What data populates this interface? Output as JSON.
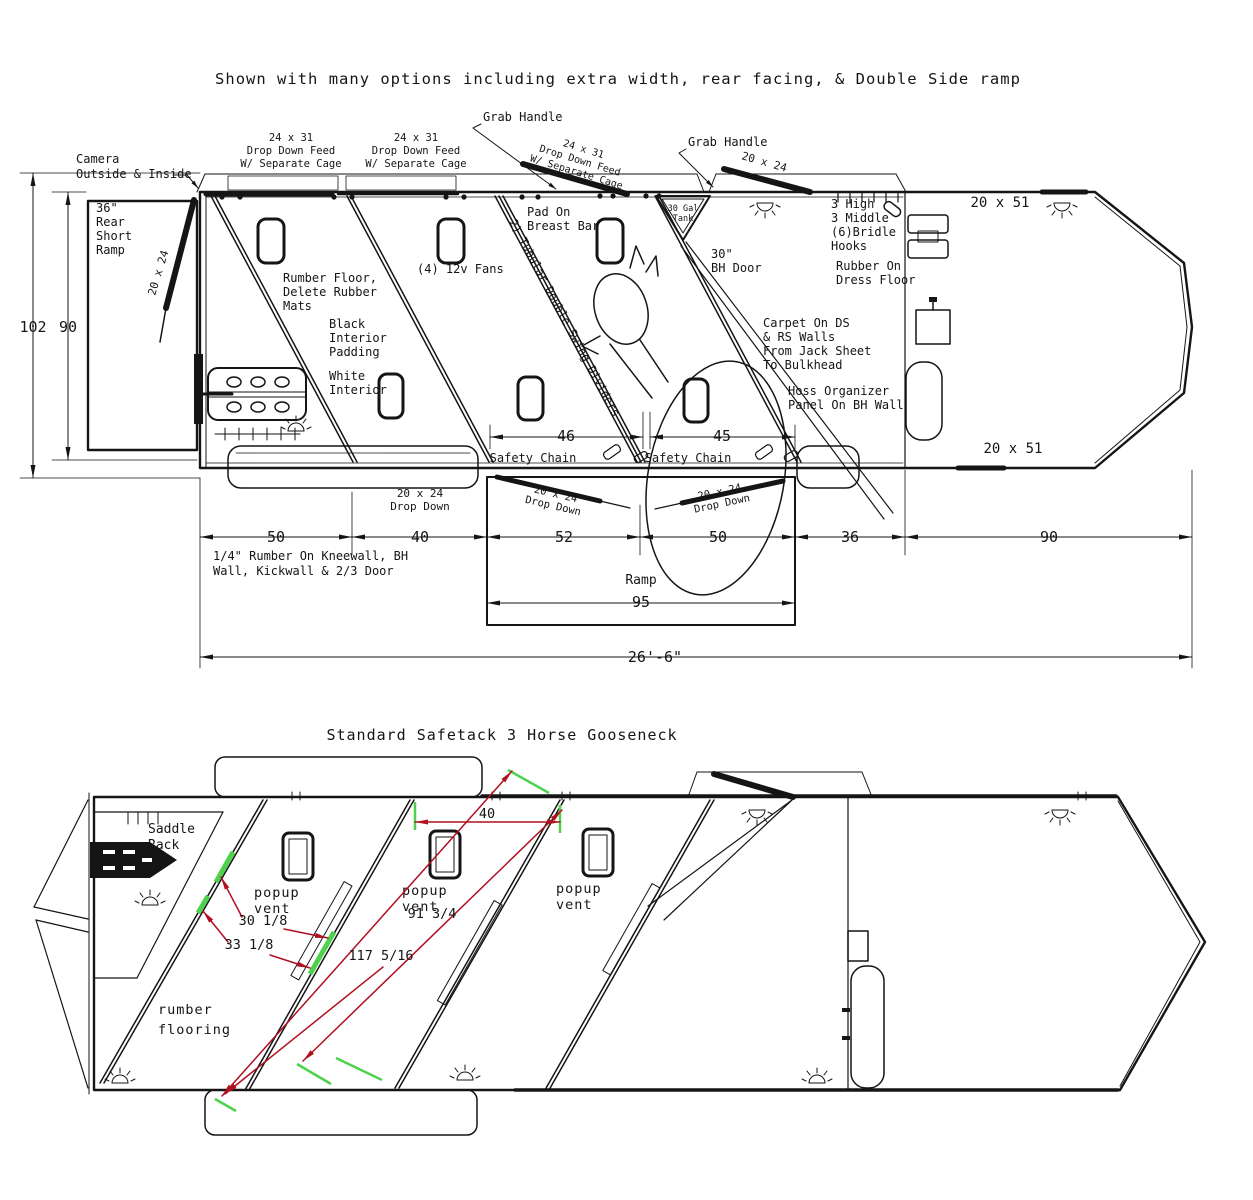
{
  "colors": {
    "ink": "#151515",
    "red": "#b01020",
    "green": "#4ed24e"
  },
  "top": {
    "title": "Shown with many options including extra width, rear facing, & Double Side ramp",
    "camera": [
      "Camera",
      "Outside & Inside"
    ],
    "rear_ramp": [
      "36\"",
      "Rear",
      "Short",
      "Ramp"
    ],
    "size_20x24": "20 x 24",
    "feed_door": [
      "24 x 31",
      "Drop Down Feed",
      "W/ Separate Cage"
    ],
    "grab_handle": "Grab Handle",
    "tank": [
      "30 Gal",
      "Tank"
    ],
    "pad": [
      "Pad On",
      "Breast Bar"
    ],
    "fans": "(4) 12v Fans",
    "rumber_floor": [
      "Rumber Floor,",
      "Delete Rubber",
      "Mats"
    ],
    "black_interior": [
      "Black",
      "Interior",
      "Padding"
    ],
    "white_interior": [
      "White",
      "Interior"
    ],
    "dividers": "2) Tubular Double Swing Dividers",
    "bh_door": [
      "30\"",
      "BH Door"
    ],
    "hooks": [
      "3 High",
      "3 Middle",
      "(6)Bridle",
      "Hooks"
    ],
    "dress": [
      "Rubber On",
      "Dress Floor"
    ],
    "carpet": [
      "Carpet On DS",
      "& RS Walls",
      "From Jack Sheet",
      "To Bulkhead"
    ],
    "hoss": [
      "Hoss Organizer",
      "Panel On BH Wall"
    ],
    "size_20x51": "20 x 51",
    "safety_chain": "Safety Chain",
    "drop_down": [
      "20 x 24",
      "Drop Down"
    ],
    "kneewall": [
      "1/4\" Rumber On Kneewall, BH",
      "Wall, Kickwall & 2/3 Door"
    ],
    "ramp": "Ramp",
    "dim": {
      "h1": "102",
      "h2": "90",
      "c1": "46",
      "c2": "45",
      "r": "95",
      "total": "26'-6\"",
      "row": [
        "50",
        "40",
        "52",
        "50",
        "36",
        "90"
      ]
    }
  },
  "bottom": {
    "title": "Standard Safetack 3 Horse Gooseneck",
    "saddle": [
      "Saddle",
      "Rack"
    ],
    "vent": [
      "popup",
      "vent"
    ],
    "floor": [
      "rumber",
      "flooring"
    ],
    "dim": {
      "w": "40",
      "a": "30 1/8",
      "b": "33 1/8",
      "c": "91 3/4",
      "d": "117 5/16"
    }
  }
}
